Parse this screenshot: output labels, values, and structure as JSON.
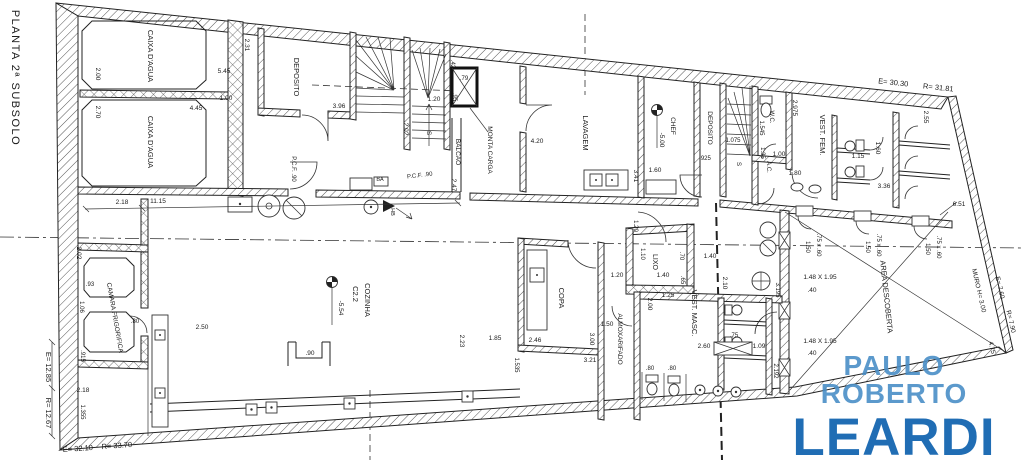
{
  "watermark": {
    "line1": "PAULO ROBERTO",
    "line2": "LEARDI",
    "color_line1": "#4a8fc7",
    "color_line2": "#1566b0"
  },
  "colors": {
    "ink": "#1b1b1b",
    "background": "#ffffff"
  },
  "labels": [
    {
      "name": "plan-title",
      "text": "PLANTA 2ª SUBSOLO",
      "x": 12,
      "y": 78,
      "rot": 90,
      "size": 11,
      "ls": 1.5
    },
    {
      "name": "room-label-caixa-dagua-1",
      "text": "CAIXA D'AGUA",
      "x": 148,
      "y": 56,
      "rot": 90,
      "size": 7.5
    },
    {
      "name": "room-label-caixa-dagua-2",
      "text": "CAIXA D'AGUA",
      "x": 148,
      "y": 142,
      "rot": 90,
      "size": 7.5
    },
    {
      "name": "room-label-deposito",
      "text": "DEPOSITO",
      "x": 294,
      "y": 77,
      "rot": 90,
      "size": 7.5
    },
    {
      "name": "room-label-monta-carga",
      "text": "MONTA CARGA",
      "x": 488,
      "y": 150,
      "rot": 90,
      "size": 6.5
    },
    {
      "name": "room-label-balcao",
      "text": "BALCAO",
      "x": 456,
      "y": 152,
      "rot": 90,
      "size": 6.5
    },
    {
      "name": "room-label-lavagem",
      "text": "LAVAGEM",
      "x": 583,
      "y": 133,
      "rot": 90,
      "size": 7.5
    },
    {
      "name": "room-label-deposito-2",
      "text": "DEPOSITO",
      "x": 708,
      "y": 128,
      "rot": 90,
      "size": 6.5
    },
    {
      "name": "room-label-wc",
      "text": "W.C.",
      "x": 770,
      "y": 117,
      "rot": 90,
      "size": 6
    },
    {
      "name": "room-label-ac",
      "text": "A.C.",
      "x": 767,
      "y": 167,
      "rot": 90,
      "size": 6
    },
    {
      "name": "room-label-vest-fem",
      "text": "VEST. FEM.",
      "x": 820,
      "y": 135,
      "rot": 90,
      "size": 7.5
    },
    {
      "name": "room-label-vest-masc",
      "text": "VEST. MASC.",
      "x": 692,
      "y": 313,
      "rot": 90,
      "size": 7.5
    },
    {
      "name": "room-label-lixo",
      "text": "LIXO",
      "x": 653,
      "y": 262,
      "rot": 90,
      "size": 7
    },
    {
      "name": "room-label-copa",
      "text": "COPA",
      "x": 559,
      "y": 298,
      "rot": 90,
      "size": 7.5
    },
    {
      "name": "room-label-almoxarifado",
      "text": "ALMOXARIFADO",
      "x": 618,
      "y": 339,
      "rot": 90,
      "size": 6.5
    },
    {
      "name": "room-label-cozinha",
      "text": "COZINHA",
      "x": 365,
      "y": 300,
      "rot": 90,
      "size": 7.5
    },
    {
      "name": "room-label-cozinha-code",
      "text": "C2.2",
      "x": 353,
      "y": 294,
      "rot": 90,
      "size": 7.5
    },
    {
      "name": "room-label-area-descoberta",
      "text": "AREA DESCOBERTA",
      "x": 884,
      "y": 297,
      "rot": 84,
      "size": 7.5
    },
    {
      "name": "room-label-camara-frigorifica",
      "text": "CAMARA FRIGORIFICA",
      "x": 113,
      "y": 318,
      "rot": 80,
      "size": 6.5
    },
    {
      "name": "wall-label-muro",
      "text": "MURO  H= 3.00",
      "x": 977,
      "y": 291,
      "rot": 77,
      "size": 6.5
    },
    {
      "name": "level-label-chef",
      "text": "CHEF",
      "x": 671,
      "y": 126,
      "rot": 90,
      "size": 6.5
    },
    {
      "name": "level-value-chef",
      "text": "-5.00",
      "x": 660,
      "y": 140,
      "rot": 90,
      "size": 6.5
    },
    {
      "name": "level-value-cozinha",
      "text": "-5.54",
      "x": 339,
      "y": 308,
      "rot": 90,
      "size": 6.5
    },
    {
      "name": "dim-label",
      "text": "2.00",
      "x": 96,
      "y": 74,
      "rot": 90,
      "size": 6.5
    },
    {
      "name": "dim-label",
      "text": "5.45",
      "x": 224,
      "y": 73,
      "rot": 0,
      "size": 6.5
    },
    {
      "name": "dim-label",
      "text": "2.70",
      "x": 96,
      "y": 112,
      "rot": 90,
      "size": 6.5
    },
    {
      "name": "dim-label",
      "text": "4.45",
      "x": 196,
      "y": 110,
      "rot": 0,
      "size": 6.5
    },
    {
      "name": "dim-label",
      "text": "2.31",
      "x": 245,
      "y": 45,
      "rot": 90,
      "size": 6.5
    },
    {
      "name": "dim-label",
      "text": "1.00",
      "x": 226,
      "y": 100,
      "rot": 0,
      "size": 6.5
    },
    {
      "name": "dim-label",
      "text": "3.96",
      "x": 339,
      "y": 108,
      "rot": 0,
      "size": 6.5
    },
    {
      "name": "dim-label",
      "text": "1.20",
      "x": 434,
      "y": 101,
      "rot": 0,
      "size": 6.5
    },
    {
      "name": "dim-label",
      "text": "2.02",
      "x": 404,
      "y": 129,
      "rot": 90,
      "size": 6.5
    },
    {
      "name": "stair-label",
      "text": "S",
      "x": 427,
      "y": 133,
      "rot": 90,
      "size": 6.5
    },
    {
      "name": "dim-label",
      "text": ".42",
      "x": 451,
      "y": 64,
      "rot": 90,
      "size": 6
    },
    {
      "name": "dim-label",
      "text": ".79",
      "x": 464,
      "y": 80,
      "rot": 0,
      "size": 6
    },
    {
      "name": "dim-label",
      "text": ".95",
      "x": 453,
      "y": 97,
      "rot": 90,
      "size": 6
    },
    {
      "name": "dim-label",
      "text": "2.47",
      "x": 452,
      "y": 185,
      "rot": 90,
      "size": 6.5
    },
    {
      "name": "door-label",
      "text": "P.C.F. .90",
      "x": 292,
      "y": 169,
      "rot": 90,
      "size": 6
    },
    {
      "name": "door-label",
      "text": "P.C.F. .90",
      "x": 420,
      "y": 177,
      "rot": -7,
      "size": 6
    },
    {
      "name": "fixture-label",
      "text": "BA",
      "x": 380,
      "y": 181,
      "rot": 0,
      "size": 5.5
    },
    {
      "name": "fixture-label",
      "text": "HB",
      "x": 391,
      "y": 212,
      "rot": 90,
      "size": 5.5
    },
    {
      "name": "dim-label",
      "text": "2.18",
      "x": 122,
      "y": 204,
      "rot": 0,
      "size": 6.5
    },
    {
      "name": "dim-label",
      "text": "11.15",
      "x": 158,
      "y": 203,
      "rot": 0,
      "size": 6.5
    },
    {
      "name": "dim-label",
      "text": "4.20",
      "x": 537,
      "y": 143,
      "rot": 0,
      "size": 6.5
    },
    {
      "name": "dim-label",
      "text": "3.41",
      "x": 634,
      "y": 176,
      "rot": 90,
      "size": 6.5
    },
    {
      "name": "dim-label",
      "text": "1.60",
      "x": 655,
      "y": 172,
      "rot": 0,
      "size": 6.5
    },
    {
      "name": "dim-label",
      "text": ".925",
      "x": 705,
      "y": 160,
      "rot": 0,
      "size": 6
    },
    {
      "name": "dim-label",
      "text": "1.075",
      "x": 733,
      "y": 142,
      "rot": 0,
      "size": 6
    },
    {
      "name": "stair-label",
      "text": "S",
      "x": 737,
      "y": 164,
      "rot": 90,
      "size": 6
    },
    {
      "name": "dim-label",
      "text": "1.545",
      "x": 760,
      "y": 128,
      "rot": 90,
      "size": 6
    },
    {
      "name": "dim-label",
      "text": "2.975",
      "x": 793,
      "y": 108,
      "rot": 90,
      "size": 6.5
    },
    {
      "name": "dim-label",
      "text": "1.35",
      "x": 761,
      "y": 153,
      "rot": 90,
      "size": 6
    },
    {
      "name": "dim-label",
      "text": "1.00",
      "x": 779,
      "y": 156,
      "rot": 0,
      "size": 6.5
    },
    {
      "name": "dim-label",
      "text": "1.80",
      "x": 795,
      "y": 175,
      "rot": 0,
      "size": 6.5
    },
    {
      "name": "dim-label",
      "text": "1.15",
      "x": 858,
      "y": 158,
      "rot": 0,
      "size": 6.5
    },
    {
      "name": "dim-label",
      "text": "1.60",
      "x": 876,
      "y": 148,
      "rot": 90,
      "size": 6.5
    },
    {
      "name": "dim-label",
      "text": "3.36",
      "x": 884,
      "y": 188,
      "rot": 0,
      "size": 6.5
    },
    {
      "name": "dim-label",
      "text": "2.55",
      "x": 924,
      "y": 117,
      "rot": 90,
      "size": 6.5
    },
    {
      "name": "survey-label",
      "text": "E= 30.30",
      "x": 893,
      "y": 85,
      "rot": 6,
      "size": 7.5
    },
    {
      "name": "survey-label",
      "text": "R= 31.81",
      "x": 938,
      "y": 90,
      "rot": 6,
      "size": 7.5
    },
    {
      "name": "dim-label",
      "text": "6.51",
      "x": 959,
      "y": 206,
      "rot": 0,
      "size": 6.5
    },
    {
      "name": "dim-label",
      "text": "1.50",
      "x": 806,
      "y": 247,
      "rot": 90,
      "size": 6
    },
    {
      "name": "dim-label",
      "text": ".75 x .60",
      "x": 817,
      "y": 245,
      "rot": 90,
      "size": 6
    },
    {
      "name": "dim-label",
      "text": "1.50",
      "x": 866,
      "y": 247,
      "rot": 90,
      "size": 6
    },
    {
      "name": "dim-label",
      "text": ".75 x .60",
      "x": 877,
      "y": 245,
      "rot": 90,
      "size": 6
    },
    {
      "name": "dim-label",
      "text": "1.50",
      "x": 926,
      "y": 249,
      "rot": 90,
      "size": 6
    },
    {
      "name": "dim-label",
      "text": ".75 x .60",
      "x": 937,
      "y": 247,
      "rot": 90,
      "size": 6
    },
    {
      "name": "dim-label",
      "text": "1.48 X 1.95",
      "x": 820,
      "y": 279,
      "rot": 0,
      "size": 6.5
    },
    {
      "name": "dim-label",
      "text": ".40",
      "x": 812,
      "y": 292,
      "rot": 0,
      "size": 6.5
    },
    {
      "name": "dim-label",
      "text": "1.48 X 1.95",
      "x": 820,
      "y": 343,
      "rot": 0,
      "size": 6.5
    },
    {
      "name": "dim-label",
      "text": ".40",
      "x": 812,
      "y": 355,
      "rot": 0,
      "size": 6.5
    },
    {
      "name": "dim-label",
      "text": "3.195",
      "x": 776,
      "y": 290,
      "rot": 90,
      "size": 6
    },
    {
      "name": "dim-label",
      "text": "2.192",
      "x": 774,
      "y": 371,
      "rot": 90,
      "size": 6
    },
    {
      "name": "survey-label",
      "text": "E= 7.60",
      "x": 998,
      "y": 288,
      "rot": 77,
      "size": 6.5
    },
    {
      "name": "survey-label",
      "text": "R= 7.90",
      "x": 1009,
      "y": 322,
      "rot": 77,
      "size": 6.5
    },
    {
      "name": "dim-label",
      "text": "4.75",
      "x": 990,
      "y": 348,
      "rot": 77,
      "size": 6.5
    },
    {
      "name": "dim-label",
      "text": "1.20",
      "x": 634,
      "y": 226,
      "rot": 90,
      "size": 6
    },
    {
      "name": "dim-label",
      "text": "1.10",
      "x": 641,
      "y": 254,
      "rot": 90,
      "size": 6
    },
    {
      "name": "dim-label",
      "text": "1.40",
      "x": 663,
      "y": 277,
      "rot": 0,
      "size": 6.5
    },
    {
      "name": "dim-label",
      "text": ".70",
      "x": 680,
      "y": 256,
      "rot": 90,
      "size": 6
    },
    {
      "name": "dim-label",
      "text": "1.40",
      "x": 710,
      "y": 258,
      "rot": 0,
      "size": 6.5
    },
    {
      "name": "dim-label",
      "text": ".65",
      "x": 681,
      "y": 280,
      "rot": 90,
      "size": 6
    },
    {
      "name": "dim-label",
      "text": "1.25",
      "x": 668,
      "y": 297,
      "rot": 0,
      "size": 6.5
    },
    {
      "name": "dim-label",
      "text": "2.00",
      "x": 648,
      "y": 304,
      "rot": 90,
      "size": 6.5
    },
    {
      "name": "dim-label",
      "text": "2.10",
      "x": 723,
      "y": 283,
      "rot": 90,
      "size": 6.5
    },
    {
      "name": "dim-label",
      "text": ".75",
      "x": 734,
      "y": 337,
      "rot": 0,
      "size": 6
    },
    {
      "name": "dim-label",
      "text": "2.60",
      "x": 704,
      "y": 348,
      "rot": 0,
      "size": 6.5
    },
    {
      "name": "dim-label",
      "text": "1.09",
      "x": 759,
      "y": 348,
      "rot": 0,
      "size": 6.5
    },
    {
      "name": "dim-label",
      "text": ".80",
      "x": 650,
      "y": 370,
      "rot": 0,
      "size": 6
    },
    {
      "name": "dim-label",
      "text": ".80",
      "x": 672,
      "y": 370,
      "rot": 0,
      "size": 6
    },
    {
      "name": "dim-label",
      "text": "1.20",
      "x": 617,
      "y": 277,
      "rot": 0,
      "size": 6.5
    },
    {
      "name": "dim-label",
      "text": "2.46",
      "x": 535,
      "y": 342,
      "rot": 0,
      "size": 6.5
    },
    {
      "name": "dim-label",
      "text": "3.00",
      "x": 590,
      "y": 339,
      "rot": 90,
      "size": 6.5
    },
    {
      "name": "dim-label",
      "text": "3.21",
      "x": 590,
      "y": 362,
      "rot": 0,
      "size": 6.5
    },
    {
      "name": "dim-label",
      "text": "1.50",
      "x": 607,
      "y": 326,
      "rot": 0,
      "size": 6.5
    },
    {
      "name": "dim-label",
      "text": "1.85",
      "x": 495,
      "y": 340,
      "rot": 0,
      "size": 6.5
    },
    {
      "name": "dim-label",
      "text": "1.535",
      "x": 515,
      "y": 365,
      "rot": 90,
      "size": 6
    },
    {
      "name": "dim-label",
      "text": "2.23",
      "x": 460,
      "y": 341,
      "rot": 90,
      "size": 6.5
    },
    {
      "name": "dim-label",
      "text": ".90",
      "x": 310,
      "y": 355,
      "rot": 0,
      "size": 6.5
    },
    {
      "name": "dim-label",
      "text": "2.50",
      "x": 202,
      "y": 329,
      "rot": 0,
      "size": 6.5
    },
    {
      "name": "dim-label",
      "text": "2.02",
      "x": 77,
      "y": 253,
      "rot": 90,
      "size": 6.5
    },
    {
      "name": "dim-label",
      "text": ".93",
      "x": 90,
      "y": 286,
      "rot": 0,
      "size": 6
    },
    {
      "name": "dim-label",
      "text": "1.06",
      "x": 80,
      "y": 307,
      "rot": 90,
      "size": 6
    },
    {
      "name": "dim-label",
      "text": ".915",
      "x": 81,
      "y": 356,
      "rot": 90,
      "size": 6
    },
    {
      "name": "dim-label",
      "text": "2.18",
      "x": 83,
      "y": 392,
      "rot": 0,
      "size": 6.5
    },
    {
      "name": "dim-label",
      "text": "1.355",
      "x": 81,
      "y": 412,
      "rot": 90,
      "size": 6
    },
    {
      "name": "dim-label",
      "text": ".80",
      "x": 135,
      "y": 323,
      "rot": 0,
      "size": 6
    },
    {
      "name": "survey-label",
      "text": "E= 12.85",
      "x": 46,
      "y": 367,
      "rot": 90,
      "size": 7.5
    },
    {
      "name": "survey-label",
      "text": "R= 12.67",
      "x": 46,
      "y": 413,
      "rot": 90,
      "size": 7.5
    },
    {
      "name": "survey-label",
      "text": "E= 32.10",
      "x": 78,
      "y": 451,
      "rot": -4,
      "size": 7.5
    },
    {
      "name": "survey-label",
      "text": "R= 33.70",
      "x": 117,
      "y": 448,
      "rot": -4,
      "size": 7.5
    }
  ]
}
